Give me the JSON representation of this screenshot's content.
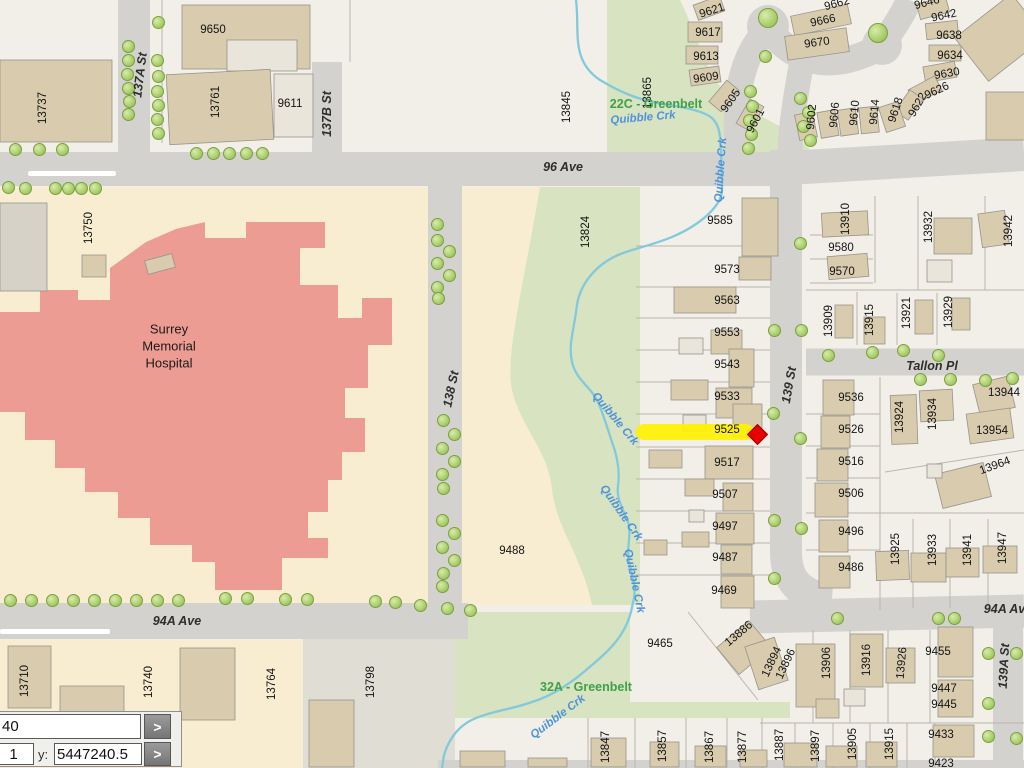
{
  "coordinate_panel": {
    "x_value": "40",
    "secondary_value": "1",
    "y_label": "y:",
    "y_value": "5447240.5",
    "go_button": ">"
  },
  "highlight": {
    "parcel": "9525",
    "band_color": "#FFF100",
    "marker_color": "#E60000"
  },
  "colors": {
    "base_parcel": "#F2EFE8",
    "cream_parcel": "#F9EDD1",
    "greenbelt": "#D8E3C1",
    "street": "#D3D2CE",
    "building": "#D8CBAE",
    "hospital": "#EC9C92",
    "creek": "#82C9DB",
    "tree": "#AACE6C"
  },
  "map": {
    "hospital_label": {
      "lines": "Surrey\nMemorial\nHospital",
      "x": 169,
      "y": 347
    },
    "street_labels": [
      {
        "t": "96 Ave",
        "x": 563,
        "y": 167,
        "r": 0
      },
      {
        "t": "94A Ave",
        "x": 177,
        "y": 621,
        "r": 0
      },
      {
        "t": "94A Ave",
        "x": 1008,
        "y": 609,
        "r": 0
      },
      {
        "t": "137A St",
        "x": 140,
        "y": 75,
        "r": -83
      },
      {
        "t": "137B St",
        "x": 327,
        "y": 114,
        "r": -90
      },
      {
        "t": "138 St",
        "x": 451,
        "y": 389,
        "r": -78
      },
      {
        "t": "139 St",
        "x": 789,
        "y": 385,
        "r": -80
      },
      {
        "t": "139A St",
        "x": 1004,
        "y": 666,
        "r": -87
      },
      {
        "t": "Tallon Pl",
        "x": 932,
        "y": 366,
        "r": 0
      }
    ],
    "creek_labels": [
      {
        "t": "Quibble Crk",
        "x": 643,
        "y": 118,
        "r": -5
      },
      {
        "t": "Quibble Crk",
        "x": 721,
        "y": 170,
        "r": -86
      },
      {
        "t": "Quibble Crk",
        "x": 615,
        "y": 419,
        "r": 50
      },
      {
        "t": "Quibble Crk",
        "x": 621,
        "y": 513,
        "r": 55
      },
      {
        "t": "Quibble Crk",
        "x": 634,
        "y": 581,
        "r": 78
      },
      {
        "t": "Quibble Crk",
        "x": 558,
        "y": 717,
        "r": -37
      }
    ],
    "greenbelt_labels": [
      {
        "t": "22C - Greenbelt",
        "x": 656,
        "y": 104,
        "r": 0
      },
      {
        "t": "32A - Greenbelt",
        "x": 586,
        "y": 687,
        "r": 0
      }
    ],
    "address_labels": [
      {
        "t": "13737",
        "x": 43,
        "y": 108,
        "r": -90
      },
      {
        "t": "9650",
        "x": 213,
        "y": 30,
        "r": 0
      },
      {
        "t": "13761",
        "x": 216,
        "y": 102,
        "r": -90
      },
      {
        "t": "9611",
        "x": 290,
        "y": 104,
        "r": 0
      },
      {
        "t": "13750",
        "x": 89,
        "y": 228,
        "r": -90
      },
      {
        "t": "13845",
        "x": 567,
        "y": 107,
        "r": -90
      },
      {
        "t": "13865",
        "x": 648,
        "y": 93,
        "r": -90
      },
      {
        "t": "9621",
        "x": 712,
        "y": 11,
        "r": -18
      },
      {
        "t": "9617",
        "x": 708,
        "y": 33,
        "r": 0
      },
      {
        "t": "9613",
        "x": 706,
        "y": 57,
        "r": 0
      },
      {
        "t": "9609",
        "x": 706,
        "y": 78,
        "r": -8
      },
      {
        "t": "9605",
        "x": 731,
        "y": 101,
        "r": -55
      },
      {
        "t": "9601",
        "x": 756,
        "y": 121,
        "r": -62
      },
      {
        "t": "9662",
        "x": 837,
        "y": 4,
        "r": -15
      },
      {
        "t": "9666",
        "x": 823,
        "y": 21,
        "r": -12
      },
      {
        "t": "9670",
        "x": 817,
        "y": 43,
        "r": -8
      },
      {
        "t": "9646",
        "x": 927,
        "y": 3,
        "r": -15
      },
      {
        "t": "9642",
        "x": 944,
        "y": 16,
        "r": -12
      },
      {
        "t": "9638",
        "x": 949,
        "y": 36,
        "r": 0
      },
      {
        "t": "9634",
        "x": 950,
        "y": 56,
        "r": 0
      },
      {
        "t": "9630",
        "x": 947,
        "y": 74,
        "r": -10
      },
      {
        "t": "9626",
        "x": 937,
        "y": 91,
        "r": -25
      },
      {
        "t": "9622",
        "x": 918,
        "y": 105,
        "r": -60
      },
      {
        "t": "9602",
        "x": 812,
        "y": 117,
        "r": -85
      },
      {
        "t": "9606",
        "x": 835,
        "y": 115,
        "r": -85
      },
      {
        "t": "9610",
        "x": 855,
        "y": 113,
        "r": -85
      },
      {
        "t": "9614",
        "x": 875,
        "y": 112,
        "r": -85
      },
      {
        "t": "9618",
        "x": 896,
        "y": 110,
        "r": -72
      },
      {
        "t": "9585",
        "x": 720,
        "y": 221,
        "r": 0
      },
      {
        "t": "9573",
        "x": 727,
        "y": 270,
        "r": 0
      },
      {
        "t": "9563",
        "x": 727,
        "y": 301,
        "r": 0
      },
      {
        "t": "9553",
        "x": 727,
        "y": 333,
        "r": 0
      },
      {
        "t": "9543",
        "x": 727,
        "y": 365,
        "r": 0
      },
      {
        "t": "9533",
        "x": 727,
        "y": 397,
        "r": 0
      },
      {
        "t": "9525",
        "x": 727,
        "y": 430,
        "r": 0
      },
      {
        "t": "9517",
        "x": 727,
        "y": 463,
        "r": 0
      },
      {
        "t": "9507",
        "x": 725,
        "y": 495,
        "r": 0
      },
      {
        "t": "9497",
        "x": 725,
        "y": 527,
        "r": 0
      },
      {
        "t": "9487",
        "x": 725,
        "y": 558,
        "r": 0
      },
      {
        "t": "9469",
        "x": 724,
        "y": 591,
        "r": 0
      },
      {
        "t": "13824",
        "x": 586,
        "y": 232,
        "r": -90
      },
      {
        "t": "9488",
        "x": 512,
        "y": 551,
        "r": 0
      },
      {
        "t": "13910",
        "x": 846,
        "y": 219,
        "r": -90
      },
      {
        "t": "9580",
        "x": 841,
        "y": 248,
        "r": 0
      },
      {
        "t": "9570",
        "x": 842,
        "y": 272,
        "r": 0
      },
      {
        "t": "13932",
        "x": 929,
        "y": 227,
        "r": -90
      },
      {
        "t": "13942",
        "x": 1009,
        "y": 231,
        "r": -90
      },
      {
        "t": "13909",
        "x": 829,
        "y": 321,
        "r": -90
      },
      {
        "t": "13915",
        "x": 870,
        "y": 320,
        "r": -90
      },
      {
        "t": "13921",
        "x": 907,
        "y": 313,
        "r": -90
      },
      {
        "t": "13929",
        "x": 949,
        "y": 312,
        "r": -90
      },
      {
        "t": "9536",
        "x": 851,
        "y": 398,
        "r": 0
      },
      {
        "t": "9526",
        "x": 851,
        "y": 430,
        "r": 0
      },
      {
        "t": "9516",
        "x": 851,
        "y": 462,
        "r": 0
      },
      {
        "t": "9506",
        "x": 851,
        "y": 494,
        "r": 0
      },
      {
        "t": "9496",
        "x": 851,
        "y": 532,
        "r": 0
      },
      {
        "t": "9486",
        "x": 851,
        "y": 568,
        "r": 0
      },
      {
        "t": "13924",
        "x": 900,
        "y": 417,
        "r": -90
      },
      {
        "t": "13934",
        "x": 933,
        "y": 414,
        "r": -90
      },
      {
        "t": "13944",
        "x": 1004,
        "y": 393,
        "r": 0
      },
      {
        "t": "13954",
        "x": 992,
        "y": 431,
        "r": 0
      },
      {
        "t": "13964",
        "x": 995,
        "y": 466,
        "r": -20
      },
      {
        "t": "13925",
        "x": 896,
        "y": 549,
        "r": -90
      },
      {
        "t": "13933",
        "x": 933,
        "y": 550,
        "r": -90
      },
      {
        "t": "13941",
        "x": 968,
        "y": 550,
        "r": -90
      },
      {
        "t": "13947",
        "x": 1003,
        "y": 548,
        "r": -90
      },
      {
        "t": "13710",
        "x": 25,
        "y": 681,
        "r": -90
      },
      {
        "t": "13740",
        "x": 149,
        "y": 682,
        "r": -90
      },
      {
        "t": "13764",
        "x": 272,
        "y": 684,
        "r": -90
      },
      {
        "t": "13798",
        "x": 371,
        "y": 682,
        "r": -90
      },
      {
        "t": "9465",
        "x": 660,
        "y": 644,
        "r": 0
      },
      {
        "t": "13886",
        "x": 739,
        "y": 634,
        "r": -40
      },
      {
        "t": "13894",
        "x": 772,
        "y": 662,
        "r": -65
      },
      {
        "t": "13896",
        "x": 786,
        "y": 664,
        "r": -65
      },
      {
        "t": "13906",
        "x": 827,
        "y": 663,
        "r": -90
      },
      {
        "t": "13916",
        "x": 867,
        "y": 660,
        "r": -90
      },
      {
        "t": "13926",
        "x": 902,
        "y": 663,
        "r": -85
      },
      {
        "t": "9455",
        "x": 938,
        "y": 652,
        "r": 0
      },
      {
        "t": "9447",
        "x": 944,
        "y": 689,
        "r": 0
      },
      {
        "t": "9445",
        "x": 944,
        "y": 705,
        "r": 0
      },
      {
        "t": "9433",
        "x": 941,
        "y": 735,
        "r": 0
      },
      {
        "t": "9423",
        "x": 941,
        "y": 764,
        "r": 0
      },
      {
        "t": "13847",
        "x": 606,
        "y": 747,
        "r": -90
      },
      {
        "t": "13857",
        "x": 663,
        "y": 746,
        "r": -90
      },
      {
        "t": "13867",
        "x": 710,
        "y": 747,
        "r": -90
      },
      {
        "t": "13877",
        "x": 743,
        "y": 747,
        "r": -90
      },
      {
        "t": "13887",
        "x": 780,
        "y": 745,
        "r": -90
      },
      {
        "t": "13897",
        "x": 816,
        "y": 746,
        "r": -90
      },
      {
        "t": "13905",
        "x": 853,
        "y": 744,
        "r": -90
      },
      {
        "t": "13915",
        "x": 890,
        "y": 744,
        "r": -90
      }
    ]
  }
}
